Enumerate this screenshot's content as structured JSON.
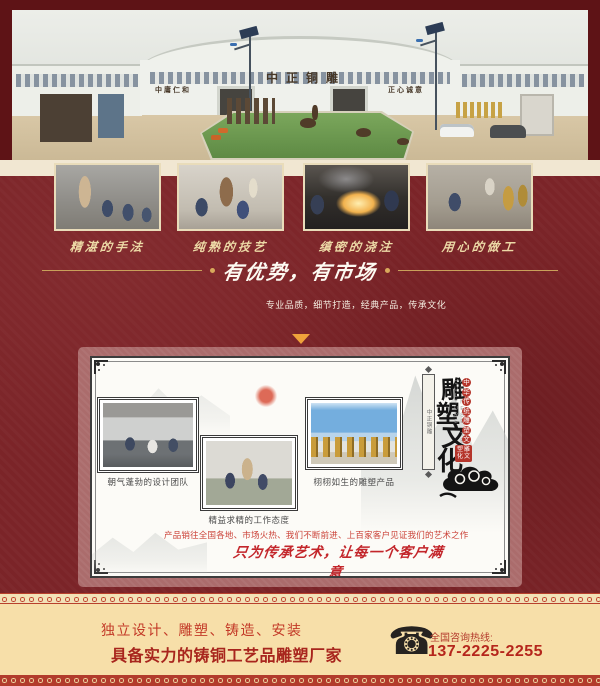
{
  "page": {
    "bg_color": "#7b2428",
    "frame_color": "#5e1316",
    "cream_color": "#f1e7d2",
    "gold_accent": "#c9a05a",
    "red_accent": "#c0392f",
    "footer_bg": "#f7dfa9",
    "footer_strip_red": "#b23c2c"
  },
  "icons": {
    "telephone": "☎"
  },
  "hero": {
    "sign_left": "中庸仁和",
    "sign_center": "中正铜雕",
    "sign_right": "正心诚意"
  },
  "process": {
    "items": [
      {
        "caption": "精湛的手法"
      },
      {
        "caption": "纯熟的技艺"
      },
      {
        "caption": "缜密的浇注"
      },
      {
        "caption": "用心的做工"
      }
    ]
  },
  "advantage": {
    "title": "有优势，有市场",
    "subtitle": "专业品质，细节打造，经典产品，传承文化"
  },
  "culture": {
    "photos": [
      {
        "caption": "朝气蓬勃的设计团队"
      },
      {
        "caption": "精益求精的工作态度"
      },
      {
        "caption": "栩栩如生的雕塑产品"
      }
    ],
    "vertical_title": "雕塑文化",
    "side_column": "中华传统雕塑文化",
    "side_english": "CHINESE TEA CULTURE",
    "seal": "雕塑文化",
    "plaque": "中正铜雕",
    "note": "产品销往全国各地、市场火热、我们不断前进、上百家客户见证我们的艺术之作",
    "slogan": "只为传承艺术，让每一个客户满意"
  },
  "footer": {
    "services": "独立设计、雕塑、铸造、安装",
    "headline": "具备实力的铸铜工艺品雕塑厂家",
    "hotline_label": "全国咨询热线:",
    "phone": "137-2225-2255"
  }
}
